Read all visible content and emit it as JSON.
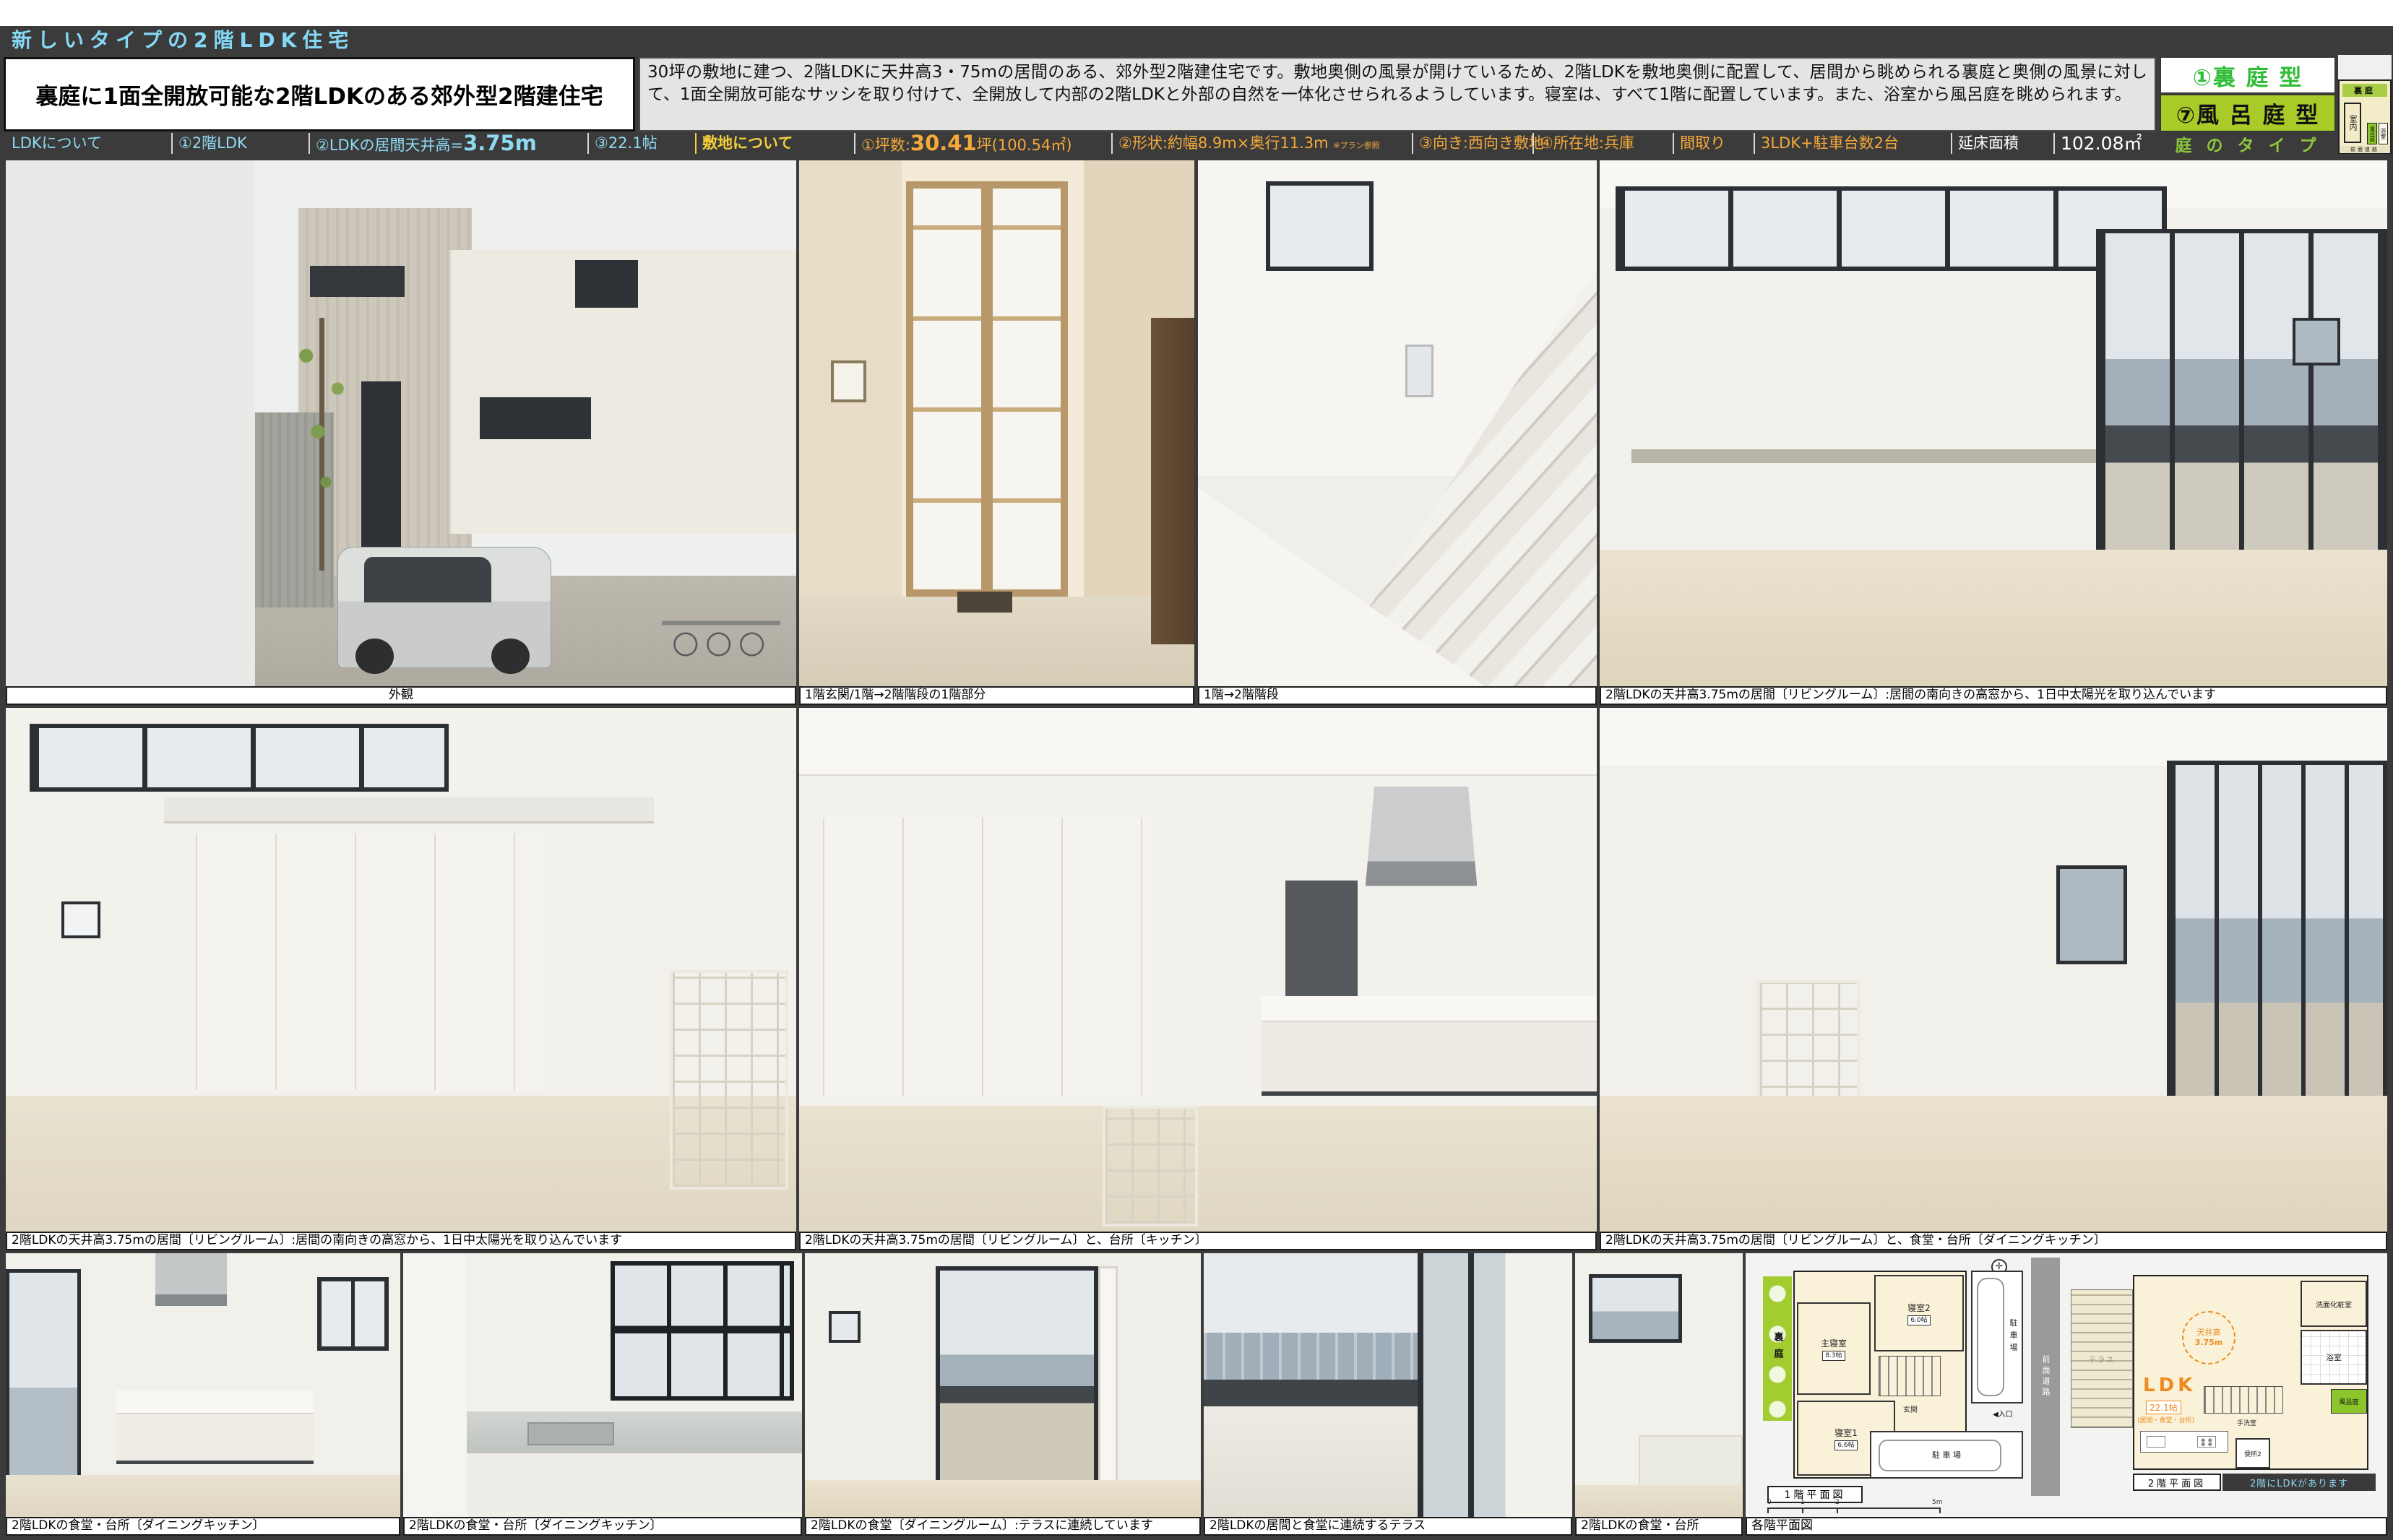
{
  "title_bar": {
    "text": "新しいタイプの2階LDK住宅"
  },
  "header": {
    "main_title": "裏庭に1面全開放可能な2階LDKのある郊外型2階建住宅",
    "description": "30坪の敷地に建つ、2階LDKに天井高3・75mの居間のある、郊外型2階建住宅です。敷地奥側の風景が開けているため、2階LDKを敷地奥側に配置して、居間から眺められる裏庭と奥側の風景に対して、1面全開放可能なサッシを取り付けて、全開放して内部の2階LDKと外部の自然を一体化させられるようしています。寝室は、すべて1階に配置しています。また、浴室から風呂庭を眺められます。",
    "garden_type_1": "①裏 庭 型",
    "garden_type_2": "⑦風 呂 庭 型",
    "garden_type_label": "庭 の タ イ プ",
    "mini_diagram": {
      "backyard": "裏庭",
      "interior": "室内",
      "bath_garden": "風呂庭",
      "bathroom": "浴室",
      "front_road": "前面道路"
    }
  },
  "spec_bar": {
    "ldk": {
      "label": "LDKについて",
      "item1": "①2階LDK",
      "item2_prefix": "②LDKの居間天井高=",
      "item2_value": "3.75m",
      "item3": "③22.1帖"
    },
    "site": {
      "label": "敷地について",
      "item1_prefix": "①坪数:",
      "item1_value": "30.41",
      "item1_suffix": "坪(100.54㎡)",
      "item2": "②形状:約幅8.9m×奥行11.3m",
      "item2_note": "※プラン参照",
      "item3": "③向き:西向き敷地",
      "item4": "④所在地:兵庫"
    },
    "layout": {
      "label": "間取り",
      "value": "3LDK+駐車台数2台"
    },
    "floor_area": {
      "label": "延床面積",
      "value": "102.08㎡"
    }
  },
  "captions": {
    "r1": [
      "外観",
      "1階玄関/1階→2階階段の1階部分",
      "1階→2階階段",
      "2階LDKの天井高3.75mの居間〔リビングルーム〕:居間の南向きの高窓から、1日中太陽光を取り込んでいます"
    ],
    "r2": [
      "2階LDKの天井高3.75mの居間〔リビングルーム〕:居間の南向きの高窓から、1日中太陽光を取り込んでいます",
      "2階LDKの天井高3.75mの居間〔リビングルーム〕と、台所〔キッチン〕",
      "2階LDKの天井高3.75mの居間〔リビングルーム〕と、食堂・台所〔ダイニングキッチン〕"
    ],
    "r3": [
      "2階LDKの食堂・台所〔ダイニングキッチン〕",
      "2階LDKの食堂・台所〔ダイニングキッチン〕",
      "2階LDKの食堂〔ダイニングルーム〕:テラスに連続しています",
      "2階LDKの居間と食堂に連続するテラス",
      "2階LDKの食堂・台所",
      "各階平面図"
    ]
  },
  "floor_plan_1f": {
    "title": "1階平面図",
    "backyard": "裏庭",
    "master_bedroom": "主寝室",
    "master_size": "8.3帖",
    "bedroom2": "寝室2",
    "bedroom2_size": "6.0帖",
    "bedroom1": "寝室1",
    "bedroom1_size": "6.6帖",
    "parking_top": "駐車場",
    "parking_bottom": "駐 車 場",
    "front_road": "前面道路",
    "entrance": "玄関",
    "entry": "◀入口",
    "scale_0": "0",
    "scale_1": "1",
    "scale_2": "2",
    "scale_5": "5m"
  },
  "floor_plan_2f": {
    "title": "2階平面図",
    "note": "2階にLDKがあります",
    "terrace": "テラス",
    "ldk": "LDK",
    "ldk_size": "22.1帖",
    "ldk_rooms": "(居間・食堂・台所)",
    "ceiling_label": "天井高",
    "ceiling_value": "3.75m",
    "washroom": "洗面化粧室",
    "bathroom": "浴室",
    "bath_garden": "風呂庭",
    "handwash": "手洗室",
    "toilet": "便所2"
  }
}
